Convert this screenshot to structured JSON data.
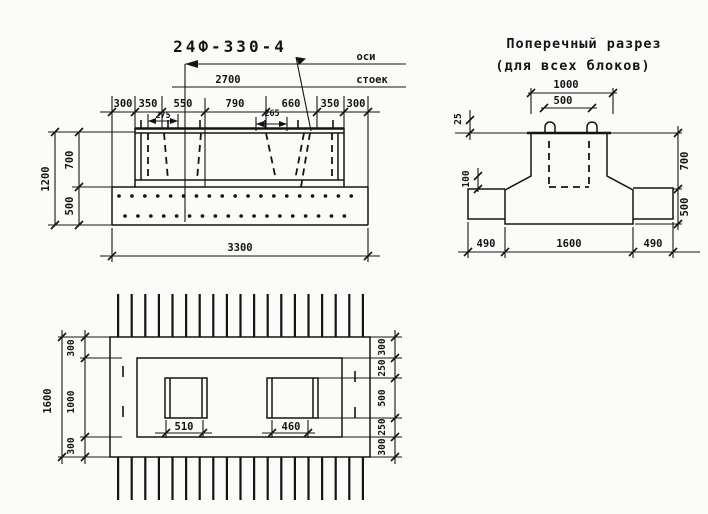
{
  "drawing": {
    "ink_color": "#141414",
    "paper_color": "#fbfbf9",
    "elevation": {
      "title": "24Ф-330-4",
      "axis_note_line1": "оси",
      "axis_note_line2": "стоек",
      "dim_span": "2700",
      "top_chain": [
        "300",
        "350",
        "550",
        "790",
        "660",
        "350",
        "300"
      ],
      "dim_socket_left": "275",
      "dim_socket_right": "265",
      "left_total": "1200",
      "left_upper": "700",
      "left_lower": "500",
      "bottom_total": "3300"
    },
    "cross_section": {
      "title_line1": "Поперечный разрез",
      "title_line2": "(для всех блоков)",
      "dim_top_total": "1000",
      "dim_top_inner": "500",
      "dim_ledge": "25",
      "dim_haunch": "100",
      "right_upper": "700",
      "right_lower": "500",
      "bottom_chain": [
        "490",
        "1600",
        "490"
      ]
    },
    "plan": {
      "left_total": "1600",
      "left_chain": [
        "300",
        "1000",
        "300"
      ],
      "right_chain": [
        "300",
        "250",
        "500",
        "250",
        "300"
      ],
      "socket_left": "510",
      "socket_right": "460"
    }
  }
}
